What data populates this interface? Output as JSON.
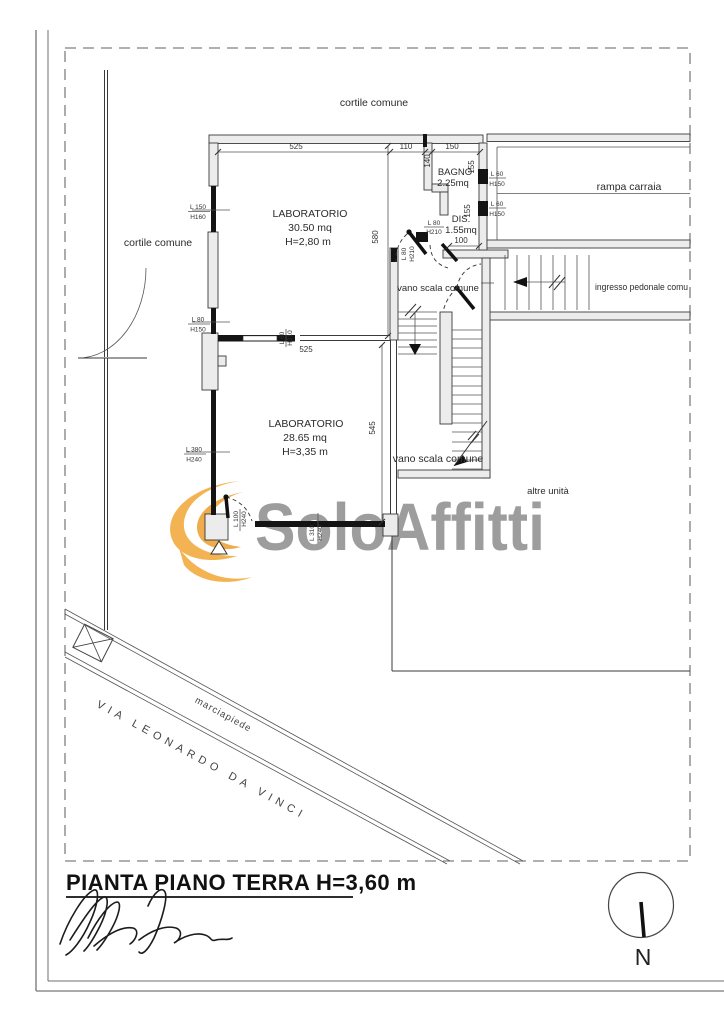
{
  "sheet": {
    "title": "PIANTA PIANO TERRA H=3,60 m",
    "north_label": "N"
  },
  "watermark": {
    "brand": "SoloAffitti",
    "accent_color": "#f2a93b",
    "text_color": "#9d9d9d"
  },
  "labels": {
    "cortile_top": "cortile comune",
    "cortile_left": "cortile comune",
    "rampa": "rampa carraia",
    "ingresso": "ingresso pedonale comu",
    "vano_scala_1": "vano scala comune",
    "vano_scala_2": "vano scala comune",
    "altre_unita": "altre unità",
    "marciapiede": "marciapiede",
    "street": "VIA LEONARDO DA VINCI"
  },
  "rooms": {
    "lab1_name": "LABORATORIO",
    "lab1_area": "30.50 mq",
    "lab1_height": "H=2,80 m",
    "lab2_name": "LABORATORIO",
    "lab2_area": "28.65 mq",
    "lab2_height": "H=3,35 m",
    "bagno_name": "BAGNO",
    "bagno_area": "2.25mq",
    "dis_name": "DIS.",
    "dis_area": "1.55mq"
  },
  "dims": {
    "top_a": "525",
    "top_b": "110",
    "top_c": "150",
    "bagno_w": "140",
    "bagno_h1": "155",
    "bagno_h2": "155",
    "dis_w": "100",
    "lab1_d": "580",
    "lab2_d": "545",
    "mid": "525"
  },
  "openings": {
    "w1l": "L 150",
    "w1h": "H160",
    "w2l": "L 80",
    "w2h": "H150",
    "w3l": "L 380",
    "w3h": "H240",
    "w4l": "L 100",
    "w4h": "H240",
    "w5l": "L 310",
    "w5h": "H240",
    "w6l": "L 60",
    "w6h": "H210",
    "w7l": "L 80",
    "w7h": "H210",
    "w8l": "L 80",
    "w8h": "H210",
    "w9l": "L 60",
    "w9h": "H150",
    "w10l": "L 60",
    "w10h": "H150"
  }
}
